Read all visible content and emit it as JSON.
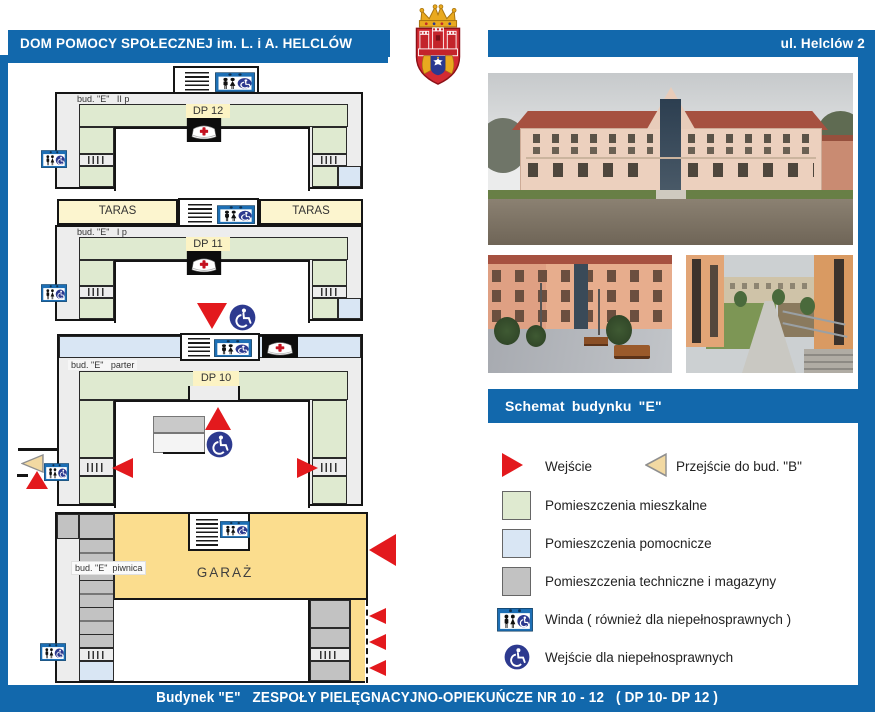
{
  "header": {
    "left_title": "DOM POMOCY SPOŁECZNEJ im. L. i A. HELCLÓW",
    "right_title": "ul. Helclów 2"
  },
  "section_bar": {
    "title": "Schemat budynku \"E\""
  },
  "plans": {
    "floor2": {
      "label": "bud. \"E\"   II p",
      "unit": "DP 12"
    },
    "floor1": {
      "label": "bud. \"E\"   I p",
      "unit": "DP 11",
      "terrace_left": "TARAS",
      "terrace_right": "TARAS"
    },
    "ground": {
      "label": "bud. \"E\"   parter",
      "unit": "DP 10"
    },
    "basement": {
      "label": "bud. \"E\"  piwnica",
      "area_label": "GARAŻ"
    }
  },
  "legend": {
    "entrance": "Wejście",
    "passage_to_b": "Przejście do bud. \"B\"",
    "residential": "Pomieszczenia mieszkalne",
    "auxiliary": "Pomieszczenia pomocnicze",
    "technical": "Pomieszczenia techniczne i magazyny",
    "elevator": "Winda ( również dla niepełnosprawnych )",
    "accessible_entrance": "Wejście dla niepełnosprawnych"
  },
  "footer": {
    "text": "Budynek \"E\"   ZESPOŁY PIELĘGNACYJNO-OPIEKUŃCZE NR 10 - 12   ( DP 10- DP 12 )"
  },
  "icons": {
    "elevator": "elevator-icon",
    "wheelchair": "wheelchair-icon",
    "nurse_station": "nurse-cap-icon",
    "stairs": "stairs-icon",
    "crest": "krakow-coat-of-arms-icon"
  },
  "colors": {
    "accent_blue": "#1268ac",
    "residential_green": "#dfead0",
    "auxiliary_blue": "#d9e6f4",
    "technical_gray": "#c2c2c2",
    "garage_yellow": "#fbdd8e",
    "terrace_yellow": "#fcf5cf",
    "entrance_red": "#e3191d",
    "passage_tan": "#f2d9a2",
    "wheelchair_navy": "#2d3a8f"
  }
}
